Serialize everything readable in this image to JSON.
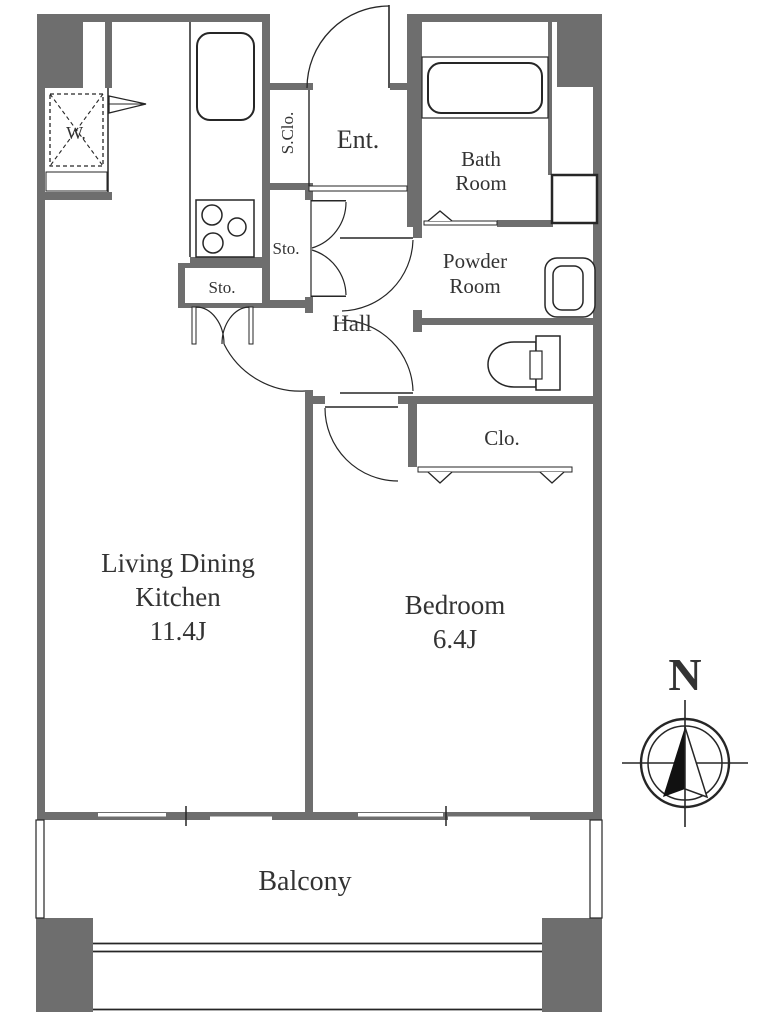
{
  "plan": {
    "rooms": {
      "ldk": {
        "name_line1": "Living Dining",
        "name_line2": "Kitchen",
        "size": "11.4J"
      },
      "bedroom": {
        "name": "Bedroom",
        "size": "6.4J"
      },
      "bath": {
        "name_line1": "Bath",
        "name_line2": "Room"
      },
      "powder": {
        "name_line1": "Powder",
        "name_line2": "Room"
      },
      "hall": {
        "name": "Hall"
      },
      "entrance": {
        "name": "Ent."
      },
      "shoe_closet": {
        "name": "S.Clo."
      },
      "storage_hall": {
        "name": "Sto."
      },
      "storage_kitchen": {
        "name": "Sto."
      },
      "closet": {
        "name": "Clo."
      },
      "balcony": {
        "name": "Balcony"
      },
      "washer_space": {
        "name": "W."
      }
    },
    "compass": {
      "north": "N"
    }
  },
  "colors": {
    "wall": "#6e6e6e",
    "line": "#262626",
    "text": "#333333",
    "bg": "#ffffff"
  }
}
